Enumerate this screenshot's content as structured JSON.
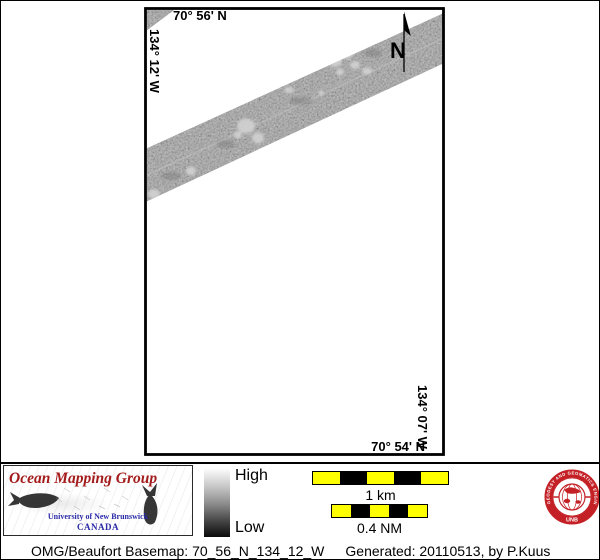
{
  "map": {
    "coord_top": "70° 56' N",
    "coord_left": "134° 12' W",
    "coord_right": "134° 07' W",
    "coord_bottom": "70° 54' N",
    "north_label": "N"
  },
  "legend": {
    "high": "High",
    "low": "Low"
  },
  "scalebars": {
    "metric_label": "1 km",
    "nautical_label": "0.4 NM"
  },
  "omg_logo": {
    "title": "Ocean Mapping Group",
    "institution": "University of New Brunswick",
    "country": "CANADA"
  },
  "unb_seal": {
    "ring_text": "GEODESY AND GEOMATICS ENGINEERING",
    "label": "UNB"
  },
  "credit": {
    "basemap": "OMG/Beaufort Basemap: 70_56_N_134_12_W",
    "generated": "Generated: 20110513, by P.Kuus"
  },
  "colors": {
    "scalebar-yellow": "#ffff00",
    "seal-red": "#c42127",
    "omg-red": "#a31b1b",
    "unb-blue": "#2a2aa8",
    "swath-gray": "#8c8c8c"
  }
}
